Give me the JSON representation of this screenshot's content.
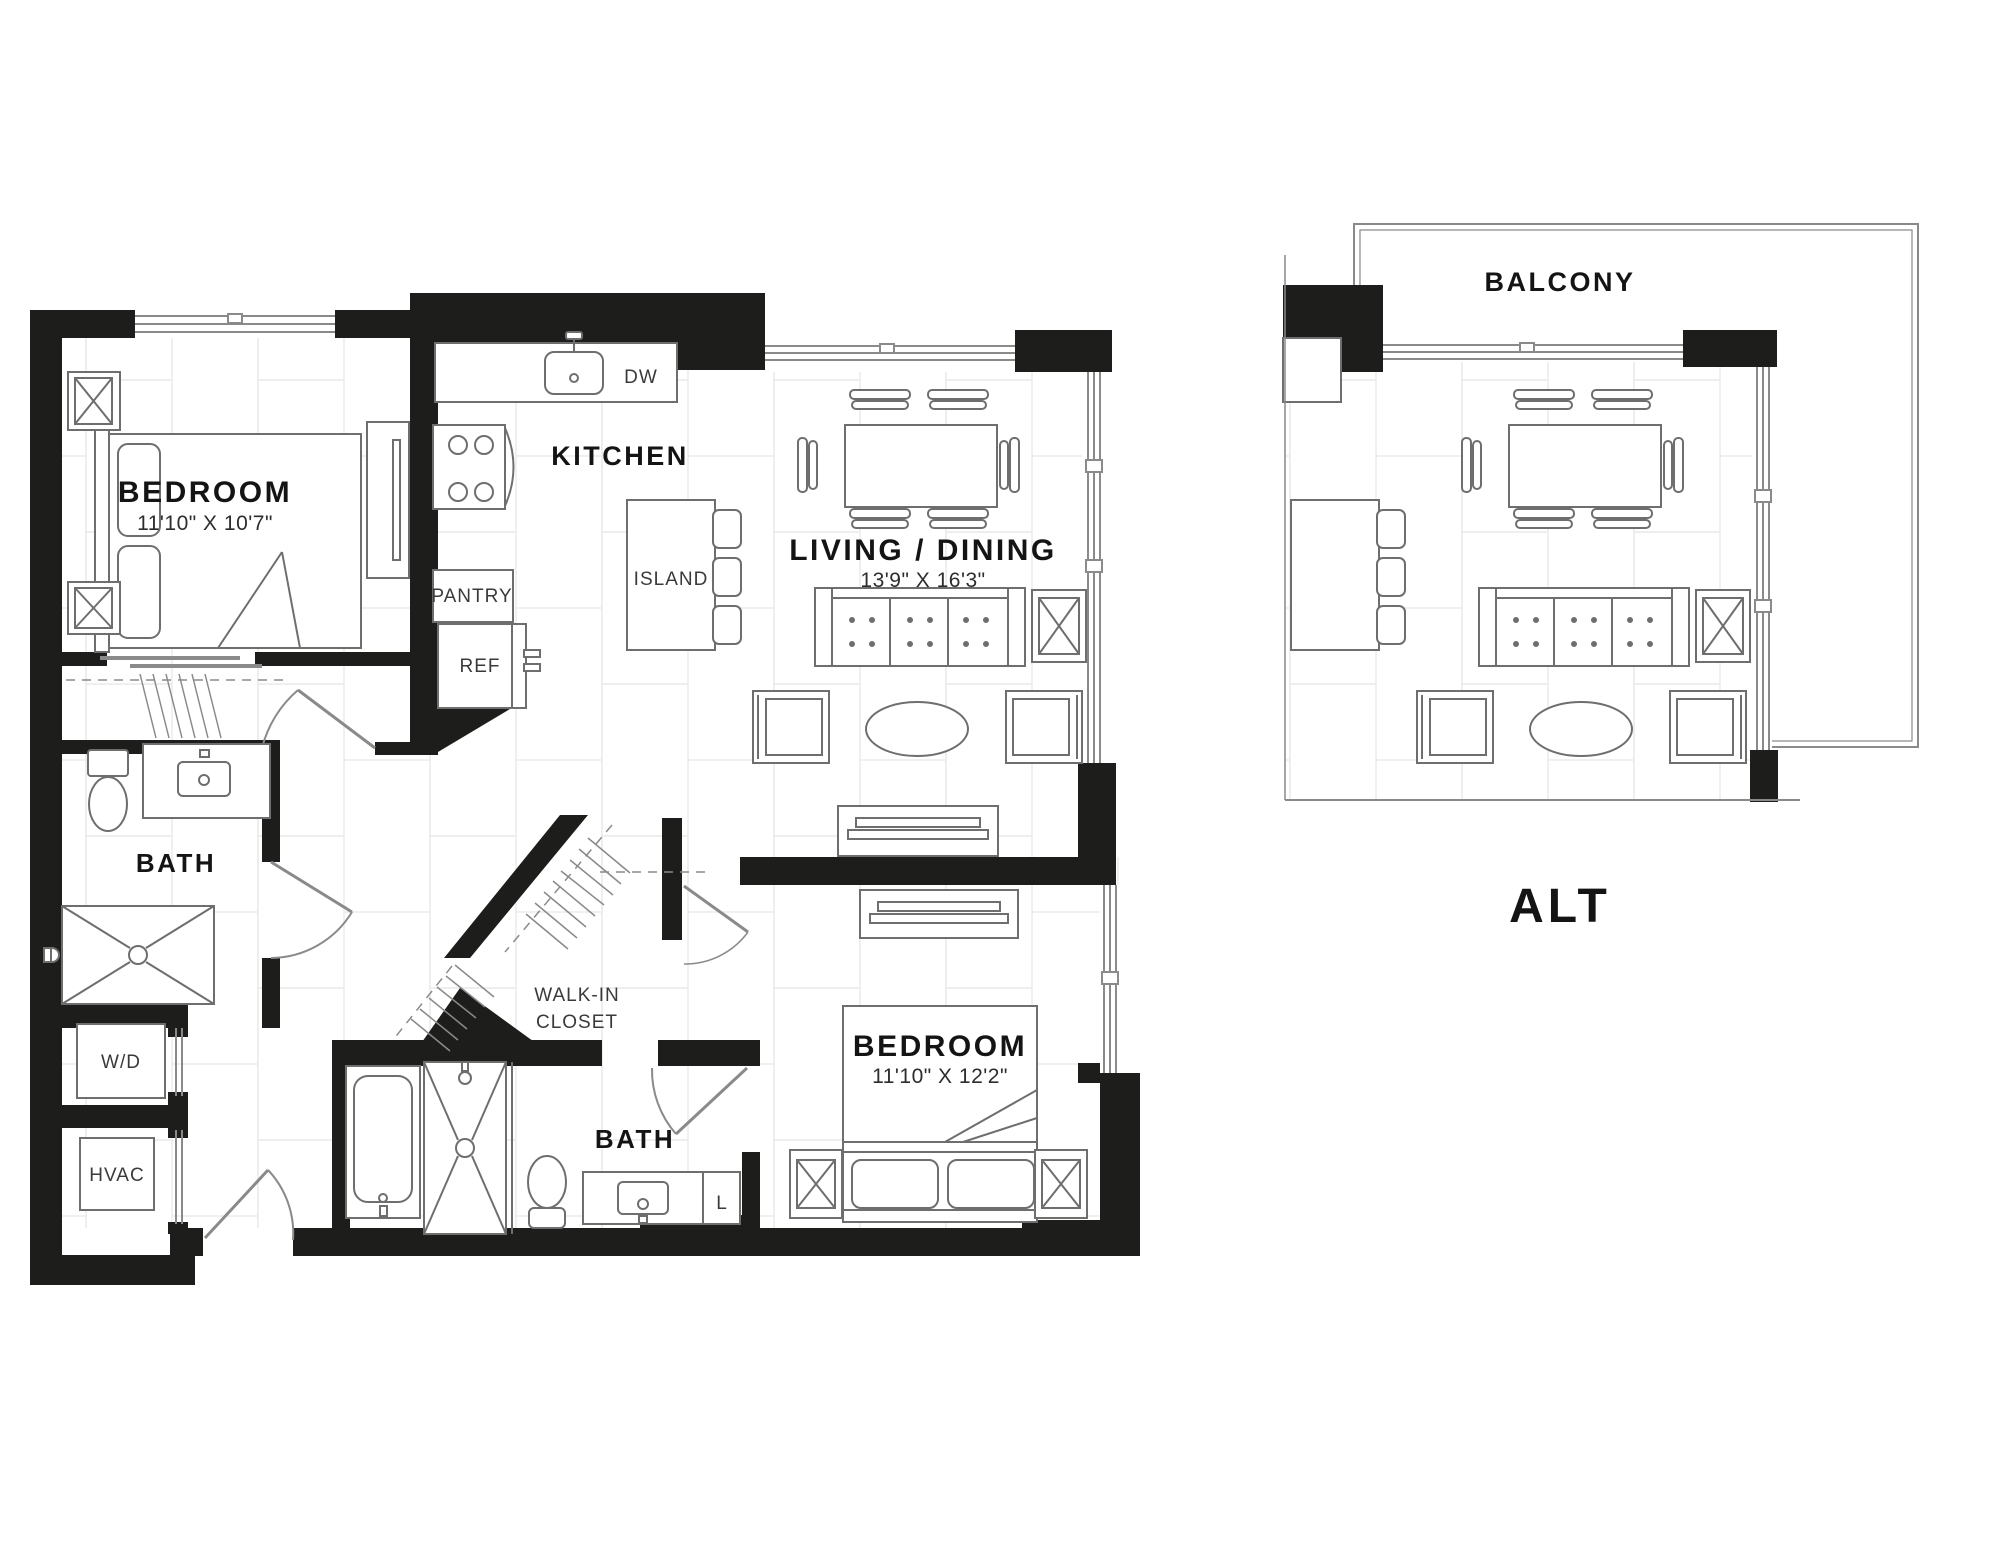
{
  "colors": {
    "wall": "#1d1d1b",
    "furniture_line": "#6e6e6e",
    "light_line": "#9a9a9a",
    "tile_line": "#ebebeb",
    "label_text": "#141414",
    "dimension_text": "#2d2d2d",
    "fixture_text": "#3a3a3a",
    "background": "#ffffff"
  },
  "main_plan": {
    "rooms": {
      "bedroom1": {
        "label": "BEDROOM",
        "dimensions": "11'10\" X 10'7\""
      },
      "kitchen": {
        "label": "KITCHEN"
      },
      "living_dining": {
        "label": "LIVING / DINING",
        "dimensions": "13'9\" X 16'3\""
      },
      "bath1": {
        "label": "BATH"
      },
      "walk_in_closet": {
        "label_line1": "WALK-IN",
        "label_line2": "CLOSET"
      },
      "bath2": {
        "label": "BATH"
      },
      "bedroom2": {
        "label": "BEDROOM",
        "dimensions": "11'10\" X 12'2\""
      }
    },
    "fixtures": {
      "dishwasher": {
        "label": "DW"
      },
      "island": {
        "label": "ISLAND"
      },
      "pantry": {
        "label": "PANTRY"
      },
      "refrigerator": {
        "label": "REF"
      },
      "washer_dryer": {
        "label": "W/D"
      },
      "hvac": {
        "label": "HVAC"
      },
      "linen": {
        "label": "L"
      }
    }
  },
  "alt_plan": {
    "balcony": {
      "label": "BALCONY"
    },
    "caption": "ALT"
  }
}
